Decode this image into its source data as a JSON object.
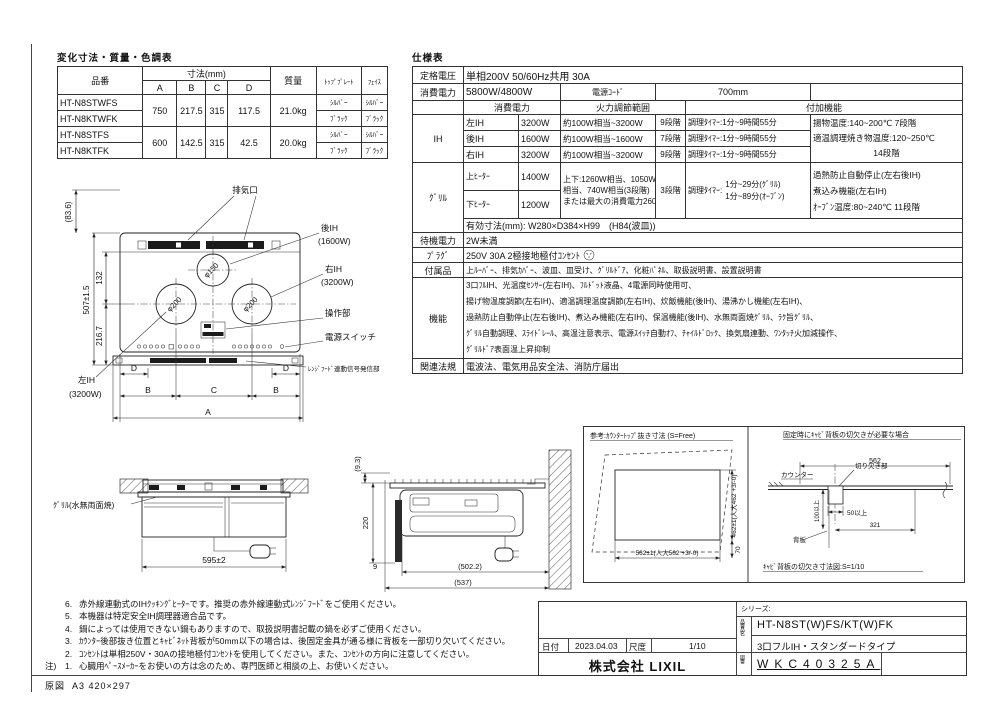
{
  "dt": {
    "title": "変化寸法・質量・色調表",
    "h": {
      "hin": "品番",
      "sun": "寸法(mm)",
      "a": "A",
      "b": "B",
      "c": "C",
      "d": "D",
      "mass": "質量",
      "top": "ﾄｯﾌﾟﾌﾟﾚｰﾄ",
      "face": "ﾌｪｲｽ"
    },
    "rows": [
      {
        "m": "HT-N8STWFS",
        "tp": "ｼﾙﾊﾞｰ",
        "fc": "ｼﾙﾊﾞｰ"
      },
      {
        "m": "HT-N8KTWFK",
        "tp": "ﾌﾞﾗｯｸ",
        "fc": "ﾌﾞﾗｯｸ"
      },
      {
        "m": "HT-N8STFS",
        "tp": "ｼﾙﾊﾞｰ",
        "fc": "ｼﾙﾊﾞｰ"
      },
      {
        "m": "HT-N8KTFK",
        "tp": "ﾌﾞﾗｯｸ",
        "fc": "ﾌﾞﾗｯｸ"
      }
    ],
    "g": [
      {
        "a": "750",
        "b": "217.5",
        "c": "315",
        "d": "117.5",
        "w": "21.0kg"
      },
      {
        "a": "600",
        "b": "142.5",
        "c": "315",
        "d": "42.5",
        "w": "20.0kg"
      }
    ]
  },
  "st": {
    "title": "仕様表",
    "rated_l": "定格電圧",
    "rated": "単相200V 50/60Hz共用 30A",
    "power_l": "消費電力",
    "power": "5800W/4800W",
    "cord_l": "電源ｺｰﾄﾞ",
    "cord": "700mm",
    "col_power": "消費電力",
    "col_range": "火力調節範囲",
    "col_extra": "付加機能",
    "ih_l": "IH",
    "ih": [
      {
        "name": "左IH",
        "w": "3200W",
        "range": "約100W相当~3200W",
        "steps": "9段階",
        "timer": "調理ﾀｲﾏｰ:1分~9時間55分"
      },
      {
        "name": "後IH",
        "w": "1600W",
        "range": "約100W相当~1600W",
        "steps": "7段階",
        "timer": "調理ﾀｲﾏｰ:1分~9時間55分"
      },
      {
        "name": "右IH",
        "w": "3200W",
        "range": "約100W相当~3200W",
        "steps": "9段階",
        "timer": "調理ﾀｲﾏｰ:1分~9時間55分"
      }
    ],
    "ih_x1": "揚物温度:140~200℃ 7段階",
    "ih_x2": "適温調理焼き物温度:120~250℃",
    "ih_x3": "14段階",
    "grill_l": "ｸﾞﾘﾙ",
    "g_up": "上ﾋｰﾀｰ",
    "g_up_w": "1400W",
    "g_dn": "下ﾋｰﾀｰ",
    "g_dn_w": "1200W",
    "g_r1": "上下:1260W相当、1050W",
    "g_r2": "相当、740W相当(3段階)",
    "g_r3": "または最大の消費電力2600W",
    "g_steps": "3段階",
    "g_t_l": "調理ﾀｲﾏｰ:",
    "g_t1": "1分~29分(ｸﾞﾘﾙ)",
    "g_t2": "1分~89分(ｵｰﾌﾞﾝ)",
    "g_x1": "過熱防止自動停止(左右後IH)",
    "g_x2": "煮込み機能(左右IH)",
    "g_x3": "ｵｰﾌﾞﾝ温度:80~240℃ 11段階",
    "eff": "有効寸法(mm): W280×D384×H99　(H84(波皿))",
    "standby_l": "待機電力",
    "standby": "2W未満",
    "plug_l": "ﾌﾟﾗｸﾞ",
    "plug": "250V 30A 2極接地極付ｺﾝｾﾝﾄ",
    "acc_l": "付属品",
    "acc": "上ﾙｰﾊﾞｰ、排気ｶﾊﾞｰ、波皿、皿受け、ｸﾞﾘﾙﾄﾞｱ、化粧ﾊﾟﾈﾙ、取扱説明書、設置説明書",
    "func_l": "機能",
    "func": [
      "3口ﾌﾙIH、光温度ｾﾝｻｰ(左右IH)、ﾌﾙﾄﾞｯﾄ液晶、4電源同時使用可、",
      "揚げ物温度調節(左右IH)、適温調理温度調節(左右IH)、炊飯機能(後IH)、湯沸かし機能(左右IH)、",
      "過熱防止自動停止(左右後IH)、煮込み機能(左右IH)、保温機能(後IH)、水無両面焼ｸﾞﾘﾙ、ﾗｸ旨ｸﾞﾘﾙ、",
      "ｸﾞﾘﾙ自動調理、ｽﾗｲﾄﾞﾚｰﾙ、高温注意表示、電源ｽｲｯﾁ自動ｵﾌ、ﾁｬｲﾙﾄﾞﾛｯｸ、換気扇連動、ﾜﾝﾀｯﾁ火加減操作、",
      "ｸﾞﾘﾙﾄﾞｱ表面温上昇抑制"
    ],
    "laws_l": "関連法規",
    "laws": "電波法、電気用品安全法、消防庁届出"
  },
  "tv": {
    "haiki": "排気口",
    "rear1": "後IH",
    "rear2": "(1600W)",
    "right1": "右IH",
    "right2": "(3200W)",
    "sousa": "操作部",
    "sw": "電源スイッチ",
    "hood": "ﾚﾝｼﾞﾌｰﾄﾞ連動信号発信部",
    "left1": "左IH",
    "left2": "(3200W)",
    "p150": "φ150",
    "p200": "φ200",
    "d836": "(83.6)",
    "d507": "507±1.5",
    "d132": "132",
    "d2167": "216.7",
    "A": "A",
    "B": "B",
    "C": "C",
    "D": "D"
  },
  "fv": {
    "label": "ｸﾞﾘﾙ(水無両面焼)",
    "dim": "595±2"
  },
  "sv": {
    "d93": "(9.3)",
    "d220": "220",
    "d9": "9",
    "d5022": "(502.2)",
    "d537": "(537)"
  },
  "cp": {
    "title": "参考:ｶｳﾝﾀｰﾄｯﾌﾟ抜き寸法 (S=Free)",
    "w": "562±1(人大562 +3/-0)",
    "h": "462±1(人大462 +3/-0)",
    "d70": "70"
  },
  "bp": {
    "title": "固定時にｷｬﾋﾞ背板の切欠きが必要な場合",
    "d562": "562",
    "counter": "カウンター",
    "notch": "切り欠き部",
    "d50": "50以上",
    "d100": "100以上",
    "d321": "321",
    "back": "背板",
    "caption": "ｷｬﾋﾞ背板の切欠き寸法図:S=1/10"
  },
  "notes": {
    "label": "注)",
    "items": [
      {
        "n": "6.",
        "t": "赤外線連動式のIHｸｯｷﾝｸﾞﾋｰﾀｰです。推奨の赤外線連動式ﾚﾝｼﾞﾌｰﾄﾞをご使用ください。"
      },
      {
        "n": "5.",
        "t": "本機器は特定安全IH調理器適合品です。"
      },
      {
        "n": "4.",
        "t": "鍋によっては使用できない鍋もありますので、取扱説明書記載の鍋を必ずご使用ください。"
      },
      {
        "n": "3.",
        "t": "ｶｳﾝﾀｰ後部抜き位置とｷｬﾋﾞﾈｯﾄ背板が50mm以下の場合は、後固定金具が通る様に背板を一部切り欠いてください。"
      },
      {
        "n": "2.",
        "t": "ｺﾝｾﾝﾄは単相250V・30Aの接地極付ｺﾝｾﾝﾄを使用してください。また、ｺﾝｾﾝﾄの方向に注意してください。"
      },
      {
        "n": "1.",
        "t": "心臓用ﾍﾟｰｽﾒｰｶｰをお使いの方は念のため、専門医師と相談の上、お使いください。"
      }
    ]
  },
  "footer": {
    "gen_l": "原図",
    "size": "A3 420×297"
  },
  "tb": {
    "series": "シリーズ:",
    "model": "HT-N8ST(W)FS/KT(W)FK",
    "product": "3口フルIH・スタンダードタイプ",
    "date_l": "日付",
    "date": "2023.04.03",
    "scale_l": "尺度",
    "scale": "1/10",
    "company": "株式会社 LIXIL",
    "col_model": "品番品名",
    "col_no": "図番",
    "no": "WKC40325A"
  }
}
